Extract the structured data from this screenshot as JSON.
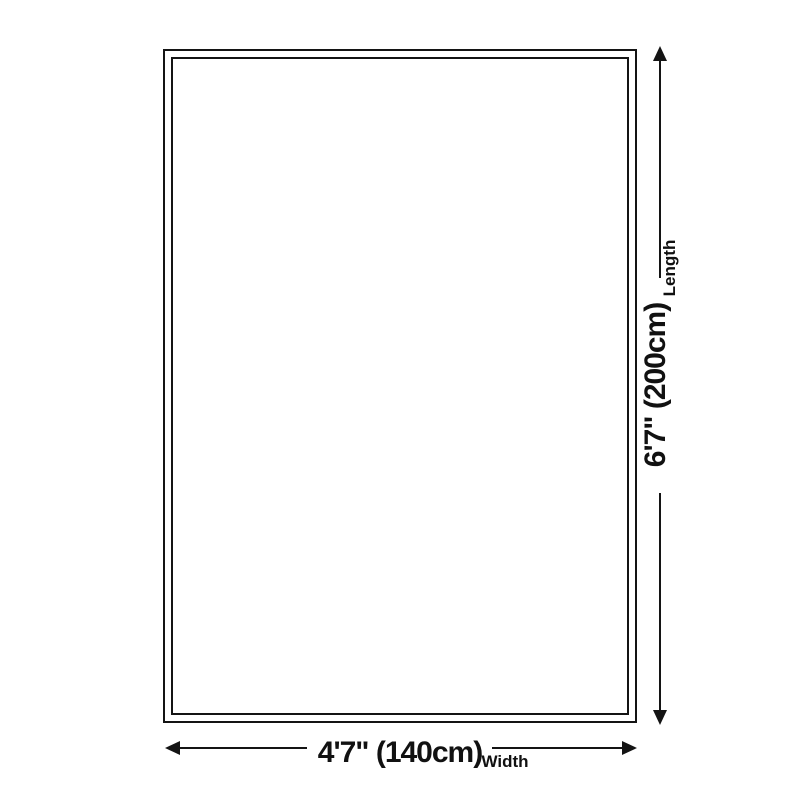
{
  "diagram": {
    "type": "product-dimension-diagram",
    "shape": "rectangle-with-double-border",
    "length": {
      "value": "6'7\" (200cm)",
      "label": "Length",
      "orientation": "vertical",
      "arrow": "double-headed-vertical"
    },
    "width": {
      "value": "4'7\" (140cm)",
      "label": "Width",
      "orientation": "horizontal",
      "arrow": "double-headed-horizontal"
    }
  },
  "icons": {
    "arrow_up": "triangle-up",
    "arrow_down": "triangle-down",
    "arrow_left": "triangle-left",
    "arrow_right": "triangle-right"
  },
  "colors": {
    "line": "#141414",
    "text": "#111111",
    "background": "#ffffff"
  }
}
